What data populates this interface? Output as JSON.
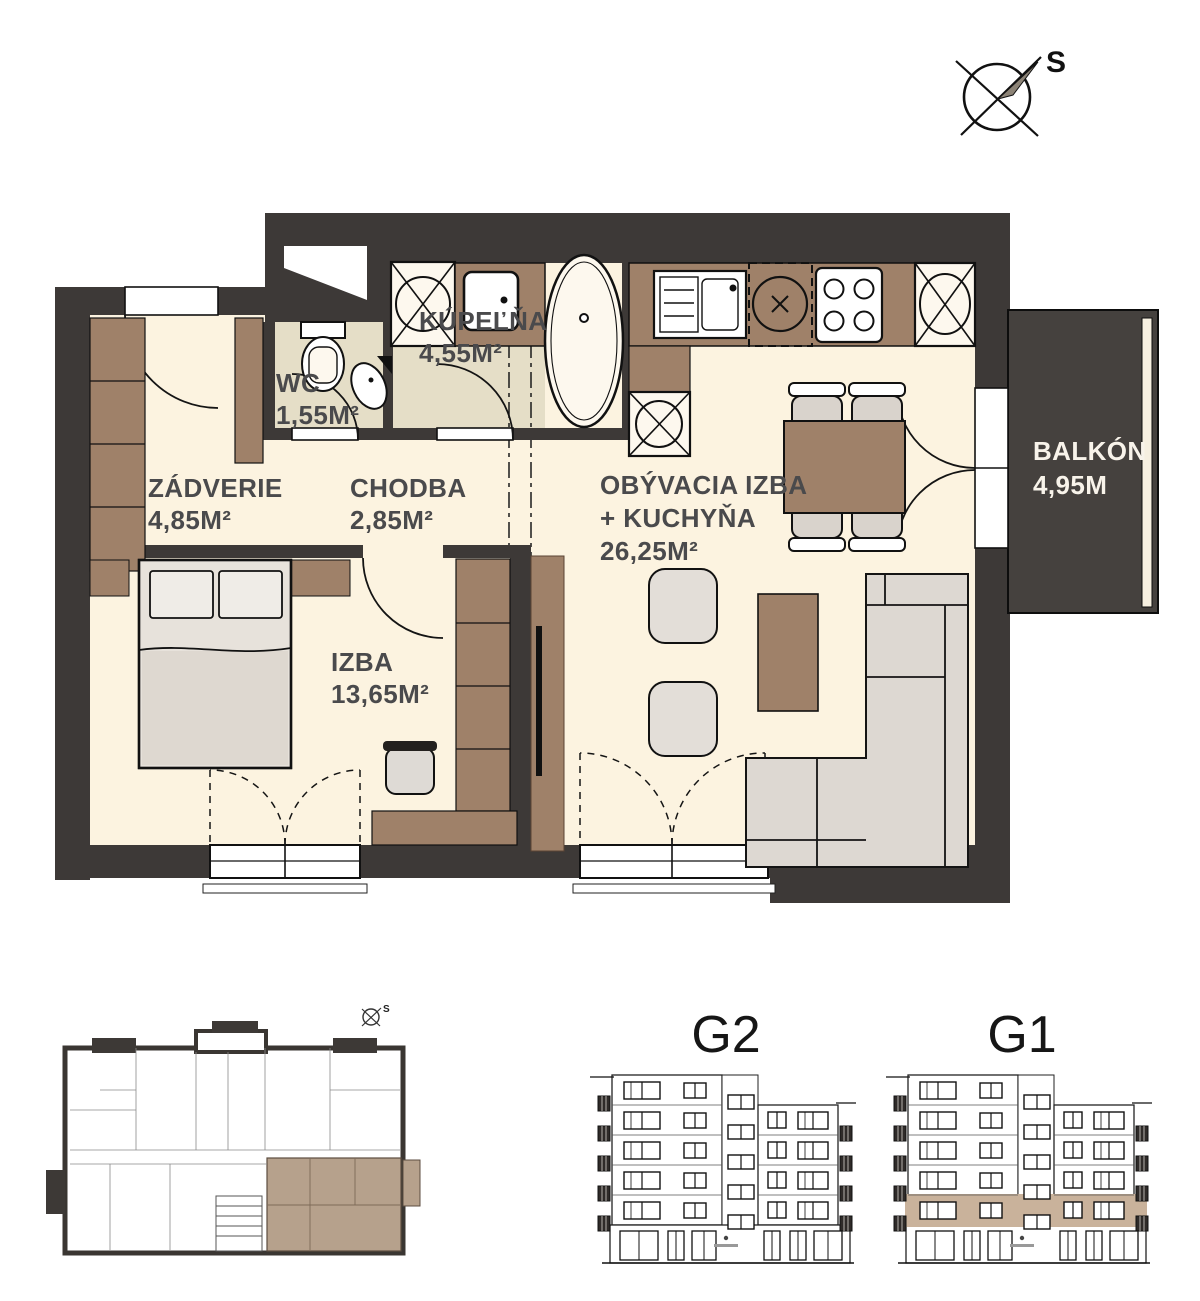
{
  "compass": {
    "label": "S"
  },
  "floor_plan": {
    "rooms": [
      {
        "id": "zadverie",
        "name": "ZÁDVERIE",
        "area": "4,85M²"
      },
      {
        "id": "chodba",
        "name": "CHODBA",
        "area": "2,85M²"
      },
      {
        "id": "wc",
        "name": "WC",
        "area": "1,55M²"
      },
      {
        "id": "kupelna",
        "name": "KÚPEĽŇA",
        "area": "4,55M²"
      },
      {
        "id": "obyvacia_izba_kuchyna",
        "name": "OBÝVACIA IZBA",
        "name2": "+ KUCHYŇA",
        "area": "26,25M²"
      },
      {
        "id": "izba",
        "name": "IZBA",
        "area": "13,65M²"
      },
      {
        "id": "balkon",
        "name": "BALKÓN",
        "area": "4,95M"
      }
    ],
    "colors": {
      "wall": "#3d3937",
      "floor": "#fcf3e0",
      "tile": "#e5dec7",
      "wood": "#9f8169",
      "soft": "#dedad5",
      "balcony": "#45413e",
      "highlight": "#c9b29b",
      "label": "#4a4a4c"
    }
  },
  "elevations": [
    {
      "label": "G2",
      "floors": 5,
      "highlight_floor": null
    },
    {
      "label": "G1",
      "floors": 5,
      "highlight_floor": 4
    }
  ],
  "site_plan": {
    "compass_label": "S"
  }
}
